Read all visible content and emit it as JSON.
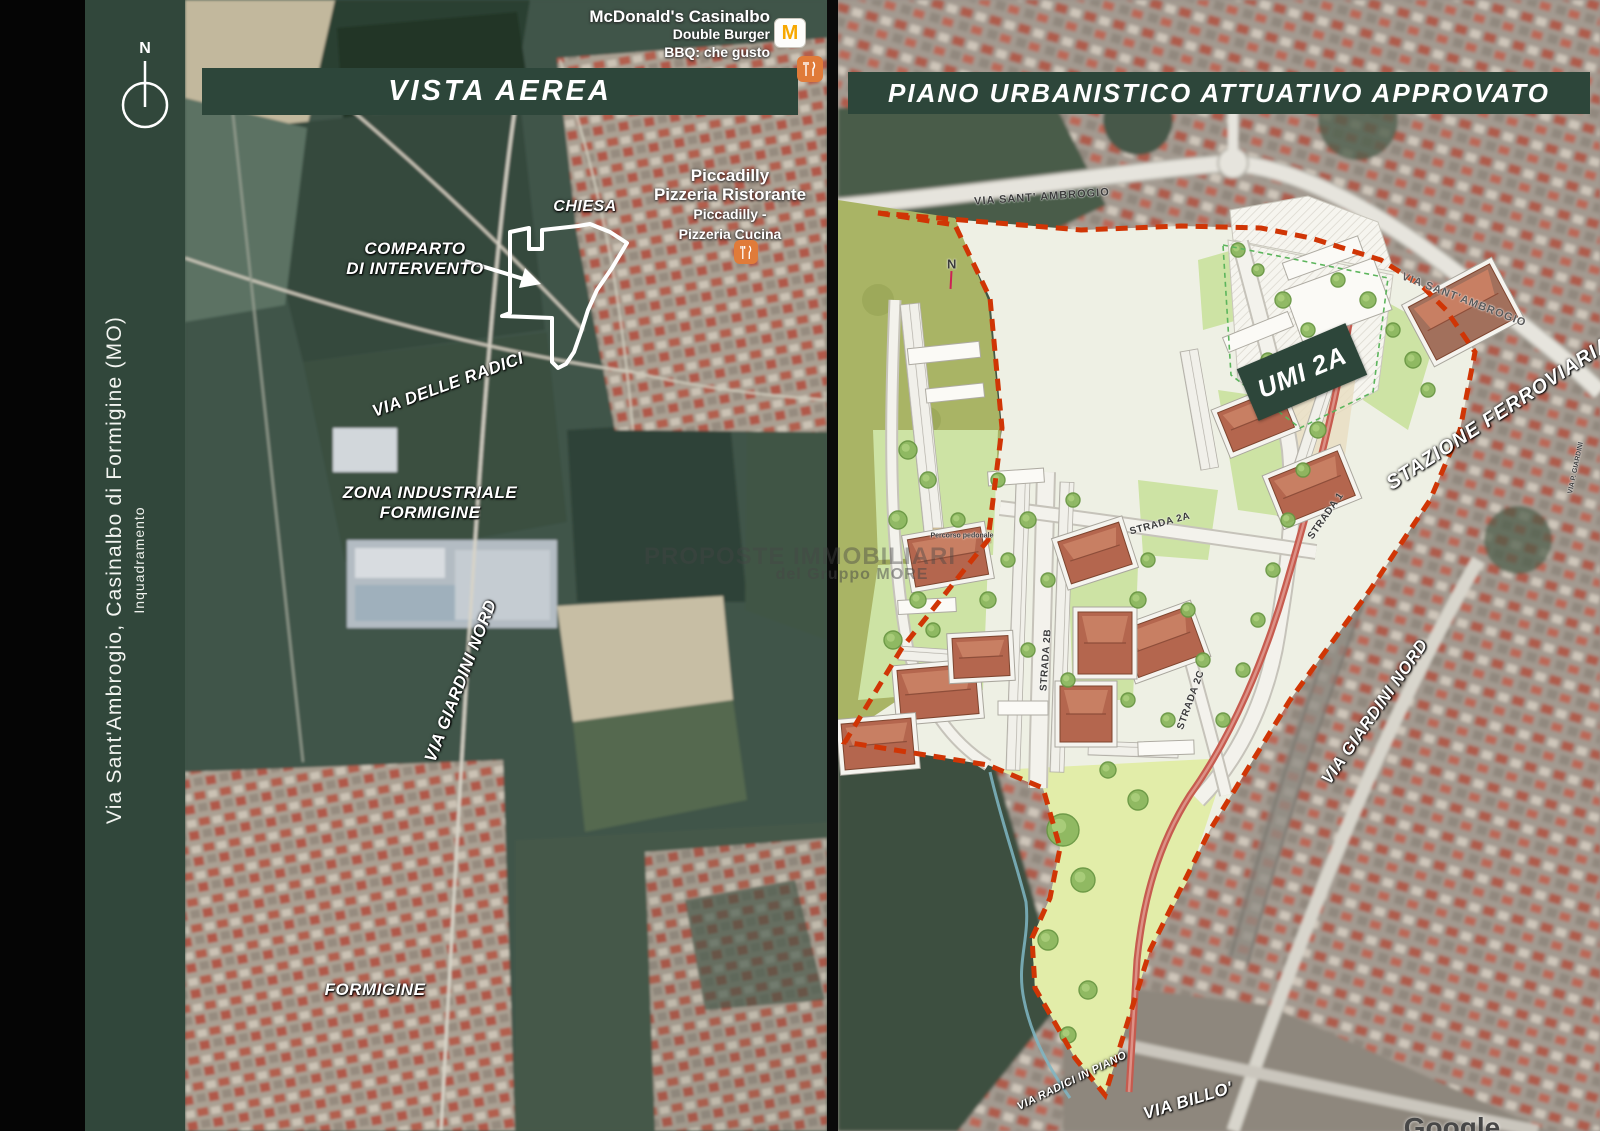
{
  "sidebar": {
    "north": "N",
    "title": "Via Sant'Ambrogio, Casinalbo di Formigine (MO)",
    "subtitle": "Inquadramento"
  },
  "left_map": {
    "banner": "VISTA AEREA",
    "mcdonalds": {
      "name": "McDonald's Casinalbo",
      "line2": "Double Burger",
      "line3": "BBQ: che gusto",
      "icon": "mcdonalds-arches",
      "m_letter": "M"
    },
    "piccadilly": {
      "name": "Piccadilly",
      "line2": "Pizzeria Ristorante",
      "alt1": "Piccadilly -",
      "alt2": "Pizzeria Cucina",
      "icon": "restaurant-fork-knife"
    },
    "labels": {
      "chiesa": "CHIESA",
      "comparto1": "COMPARTO",
      "comparto2": "DI INTERVENTO",
      "via_delle_radici": "VIA DELLE RADICI",
      "zona1": "ZONA INDUSTRIALE",
      "zona2": "FORMIGINE",
      "via_giardini_nord": "VIA GIARDINI NORD",
      "formigine": "FORMIGINE"
    }
  },
  "right_map": {
    "banner": "PIANO URBANISTICO ATTUATIVO APPROVATO",
    "north": "N",
    "umi_badge": "UMI 2A",
    "labels": {
      "via_sant_ambrogio_top": "VIA SANT' AMBROGIO",
      "strada_1": "STRADA 1",
      "strada_2a": "STRADA 2A",
      "strada_2b": "STRADA 2B",
      "strada_2c": "STRADA 2C",
      "percorso_pedonale": "Percorso pedonale",
      "stazione_ferroviaria": "STAZIONE FERROVIARIA",
      "via_sant_ambrogio_right": "VIA SANT'AMBROGIO",
      "via_p_giardini": "VIA P. GIARDINI",
      "via_giardini_nord": "VIA GIARDINI NORD",
      "via_radici_in_piano": "VIA RADICI IN PIANO",
      "via_billo": "VIA BILLO'"
    }
  },
  "watermark": {
    "line1": "PROPOSTE IMMOBILIARI",
    "line2": "del Gruppo MORE",
    "map_credit": "Google"
  },
  "colors": {
    "panel_green": "#2d463a",
    "boundary_red": "#d03505",
    "mcdonalds_yellow": "#f7a800",
    "poi_orange": "#e07b39",
    "plan_lawn_green": "#cde3a4",
    "park_green": "#e2eda9",
    "olive_field": "#a9b465",
    "roof_terracotta": "#b4664e"
  }
}
